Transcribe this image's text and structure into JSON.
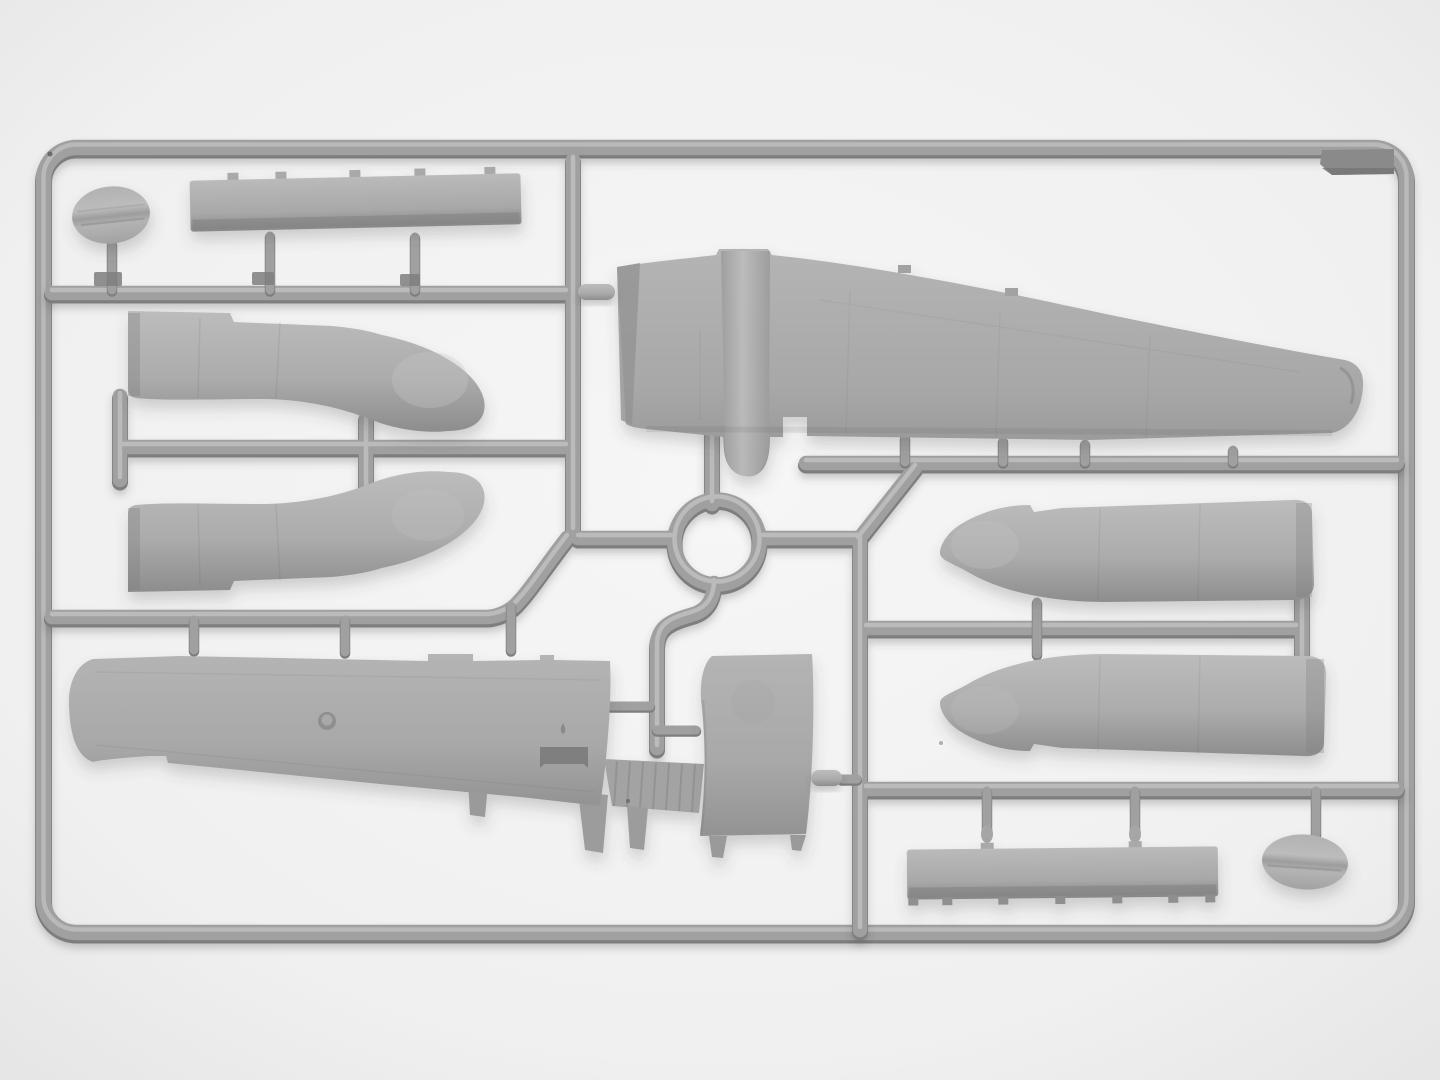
{
  "meta": {
    "type": "photograph",
    "subject": "Injection-molded plastic model kit sprue (gray styrene) holding aircraft parts",
    "orientation": "landscape"
  },
  "palette": {
    "background": "#f4f4f4",
    "background_edge": "#e6e6e6",
    "runner_mid": "#a0a0a0",
    "runner_dark": "#7e7e7e",
    "runner_highlight": "#c4c4c4",
    "plastic_light": "#bcbcbc",
    "plastic_mid": "#aaaaaa",
    "plastic_dark": "#8d8d8d",
    "corner_tab": "#8a8a8a",
    "shadow": "#bdbdbd"
  },
  "parts": [
    {
      "id": "frame",
      "label": "rectangular sprue frame with rounded corners"
    },
    {
      "id": "runners",
      "label": "internal runner network with central ring"
    },
    {
      "id": "gates",
      "label": "thin gate stubs connecting parts to runners"
    },
    {
      "id": "oval-top-left",
      "label": "oval disc part, top left"
    },
    {
      "id": "strip-top",
      "label": "long narrow flap strip part, top"
    },
    {
      "id": "cowl-upper-left",
      "label": "engine cowling half, upper left (nose pointing right)"
    },
    {
      "id": "cowl-lower-left",
      "label": "engine cowling half, lower left (mirror)"
    },
    {
      "id": "wing-upper",
      "label": "large upper wing half with center fairing, top center"
    },
    {
      "id": "nacelle-upper-right",
      "label": "engine nacelle half, right side upper (nose pointing left)"
    },
    {
      "id": "nacelle-lower-right",
      "label": "engine nacelle half, right side lower (mirror)"
    },
    {
      "id": "wing-lower",
      "label": "long lower wing half with ribbed flap bay, bottom left"
    },
    {
      "id": "center-section",
      "label": "trapezoid center-section part, bottom middle"
    },
    {
      "id": "bullet-small",
      "label": "small bullet-shaped part on center runner"
    },
    {
      "id": "knob-small",
      "label": "small capsule part at wing-root gate"
    },
    {
      "id": "strip-bottom",
      "label": "long narrow flap strip part, bottom right"
    },
    {
      "id": "oval-bottom-right",
      "label": "oval disc part, bottom right"
    },
    {
      "id": "corner-tab",
      "label": "dark molded gusset tab, top-right frame corner"
    }
  ]
}
